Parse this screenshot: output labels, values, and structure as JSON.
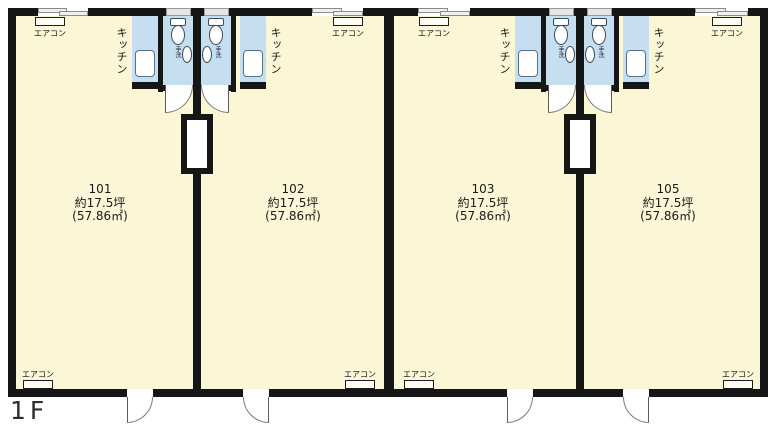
{
  "floor_label": "1F",
  "units": [
    {
      "id": "101",
      "area_tsubo": "約17.5坪",
      "area_m2": "(57.86㎡)"
    },
    {
      "id": "102",
      "area_tsubo": "約17.5坪",
      "area_m2": "(57.86㎡)"
    },
    {
      "id": "103",
      "area_tsubo": "約17.5坪",
      "area_m2": "(57.86㎡)"
    },
    {
      "id": "105",
      "area_tsubo": "約17.5坪",
      "area_m2": "(57.86㎡)"
    }
  ],
  "fixtures": {
    "aircon": "エアコン",
    "kitchen": "キッチン",
    "handwash": "手洗"
  },
  "colors": {
    "floor": "#faf6d6",
    "wet_area": "#c5def0",
    "wall": "#161616",
    "door_swing": "#ffffff",
    "background": "#ffffff"
  }
}
